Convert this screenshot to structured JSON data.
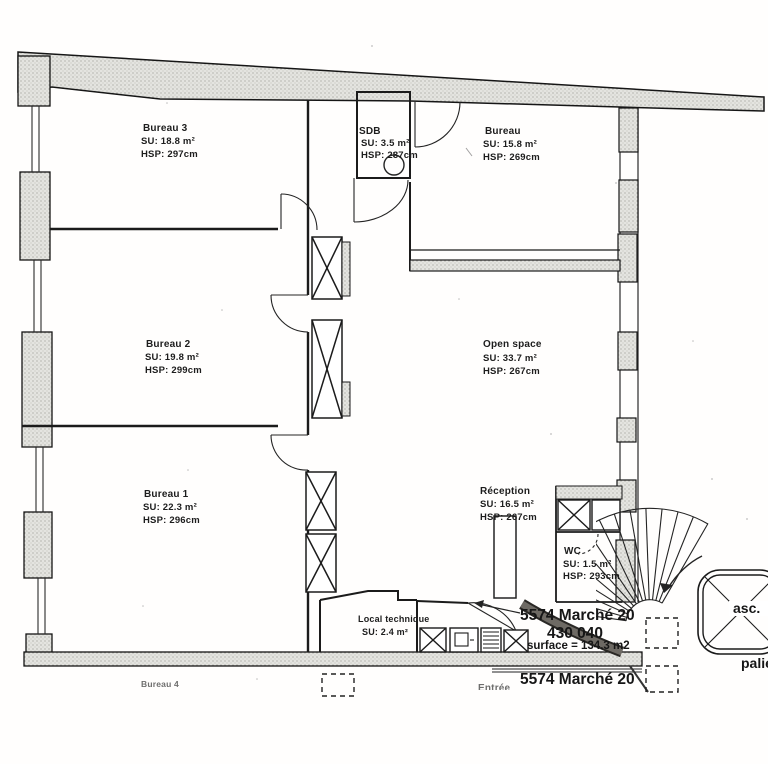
{
  "drawing": {
    "kind": "scanned office floor plan"
  },
  "rooms": [
    {
      "name": "Bureau 3",
      "su": "SU:  18.8 m²",
      "hsp": "HSP:  297cm"
    },
    {
      "name": "SDB",
      "su": "SU:  3.5 m²",
      "hsp": "HSP:  237cm"
    },
    {
      "name": "Bureau",
      "su": "SU:  15.8 m²",
      "hsp": "HSP:  269cm"
    },
    {
      "name": "Bureau 2",
      "su": "SU:  19.8 m²",
      "hsp": "HSP:  299cm"
    },
    {
      "name": "Open space",
      "su": "SU:  33.7 m²",
      "hsp": "HSP:  267cm"
    },
    {
      "name": "Bureau 1",
      "su": "SU:  22.3 m²",
      "hsp": "HSP:  296cm"
    },
    {
      "name": "Réception",
      "su": "SU:  16.5 m²",
      "hsp": "HSP:  267cm"
    },
    {
      "name": "WC",
      "su": "SU:  1.5 m²",
      "hsp": "HSP:  293cm"
    },
    {
      "name": "Local technique",
      "su": "SU:  2.4 m²"
    },
    {
      "name": "Bureau 4"
    }
  ],
  "annotations": {
    "lot_title": "5574 Marché 20",
    "lot_number": "430 040",
    "lot_surface": "surface = 134.3 m2",
    "lot_title_repeat": "5574 Marché 20",
    "entrance": "Entrée",
    "elevator": "asc.",
    "landing": "palier"
  },
  "colors": {
    "line": "#161616",
    "wall_fill": "#e3e3df",
    "paper": "#fffefd"
  }
}
